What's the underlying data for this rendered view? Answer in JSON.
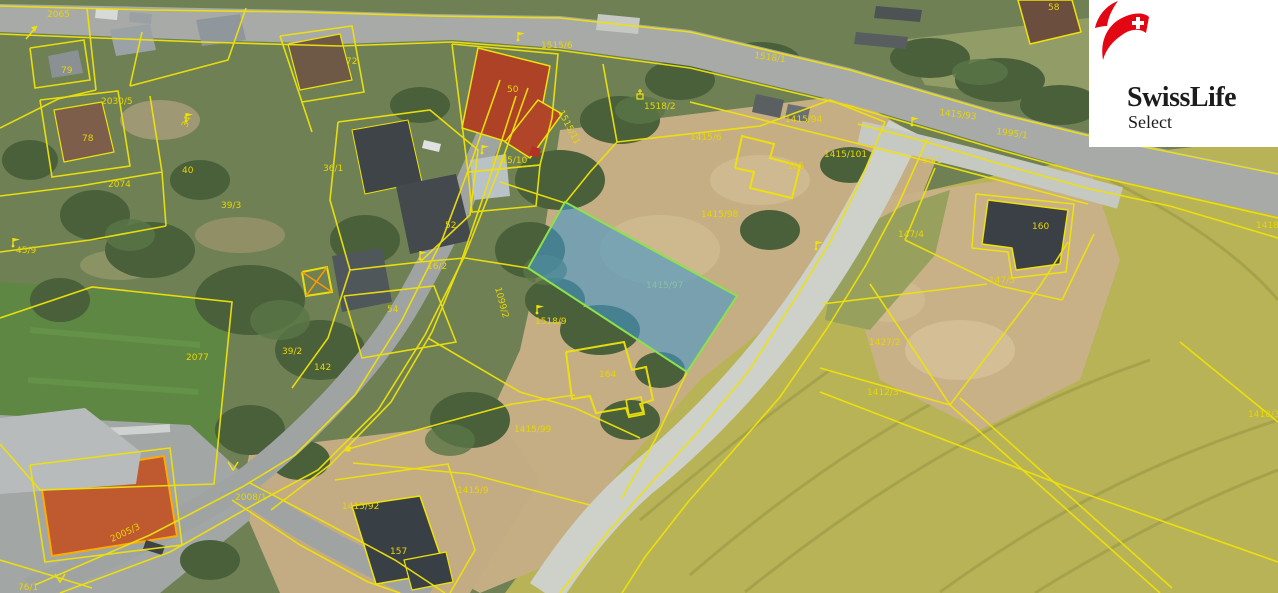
{
  "map": {
    "description": "aerial cadastral map",
    "colors": {
      "cadastral_line": "#efe20a",
      "label": "#e8d600",
      "highlight_fill": "#4596cb",
      "highlight_fill_opacity": 0.6,
      "highlight_stroke": "#8ce24a",
      "orange_highlight": "#ffa200",
      "field": "#b8b356",
      "dirt": "#c6ae84",
      "road": "#a8aaa7",
      "gravel": "#cdd1ca"
    },
    "highlight_parcel": {
      "label": "1415/97"
    },
    "labels": [
      {
        "t": "2065",
        "x": 47,
        "y": 17
      },
      {
        "t": "79",
        "x": 61,
        "y": 73
      },
      {
        "t": "2030/5",
        "x": 101,
        "y": 104
      },
      {
        "t": "78",
        "x": 82,
        "y": 141
      },
      {
        "t": "34",
        "x": 187,
        "y": 128,
        "r": -70
      },
      {
        "t": "40",
        "x": 182,
        "y": 173
      },
      {
        "t": "2074",
        "x": 108,
        "y": 187
      },
      {
        "t": "45/9",
        "x": 16,
        "y": 253
      },
      {
        "t": "39/3",
        "x": 221,
        "y": 208
      },
      {
        "t": "36/1",
        "x": 323,
        "y": 171
      },
      {
        "t": "72",
        "x": 346,
        "y": 64
      },
      {
        "t": "52",
        "x": 445,
        "y": 228
      },
      {
        "t": "16/2",
        "x": 427,
        "y": 269
      },
      {
        "t": "54",
        "x": 387,
        "y": 312
      },
      {
        "t": "2077",
        "x": 186,
        "y": 360
      },
      {
        "t": "39/2",
        "x": 282,
        "y": 354
      },
      {
        "t": "142",
        "x": 314,
        "y": 370
      },
      {
        "t": "1515/6",
        "x": 541,
        "y": 48
      },
      {
        "t": "50",
        "x": 507,
        "y": 92
      },
      {
        "t": "1515/10",
        "x": 490,
        "y": 163
      },
      {
        "t": "1515/11",
        "x": 558,
        "y": 112,
        "r": 62
      },
      {
        "t": "1518/2",
        "x": 644,
        "y": 109
      },
      {
        "t": "1415/6",
        "x": 690,
        "y": 140
      },
      {
        "t": "1415/94",
        "x": 785,
        "y": 122
      },
      {
        "t": "1518/1",
        "x": 754,
        "y": 58,
        "r": 8
      },
      {
        "t": "1415/93",
        "x": 939,
        "y": 115,
        "r": 7
      },
      {
        "t": "1995/1",
        "x": 996,
        "y": 134,
        "r": 8
      },
      {
        "t": "58",
        "x": 1048,
        "y": 10
      },
      {
        "t": "58/1",
        "x": 922,
        "y": 163
      },
      {
        "t": "1415/98",
        "x": 701,
        "y": 217
      },
      {
        "t": "165",
        "x": 787,
        "y": 169
      },
      {
        "t": "1415/101",
        "x": 824,
        "y": 157
      },
      {
        "t": "160",
        "x": 1032,
        "y": 229
      },
      {
        "t": "147/4",
        "x": 898,
        "y": 237
      },
      {
        "t": "147/5",
        "x": 989,
        "y": 283
      },
      {
        "t": "1427/2",
        "x": 869,
        "y": 345
      },
      {
        "t": "1412/3",
        "x": 867,
        "y": 395
      },
      {
        "t": "1418/3",
        "x": 1248,
        "y": 417
      },
      {
        "t": "1418/5",
        "x": 1256,
        "y": 228
      },
      {
        "t": "1099/2",
        "x": 495,
        "y": 288,
        "r": 75
      },
      {
        "t": "1518/9",
        "x": 535,
        "y": 324
      },
      {
        "t": "164",
        "x": 599,
        "y": 377
      },
      {
        "t": "1415/97",
        "x": 646,
        "y": 288,
        "c": "#9fd6a0",
        "o": 0.5
      },
      {
        "t": "1415/99",
        "x": 514,
        "y": 432
      },
      {
        "t": "1415/9",
        "x": 457,
        "y": 493
      },
      {
        "t": "1415/92",
        "x": 342,
        "y": 509
      },
      {
        "t": "157",
        "x": 390,
        "y": 554
      },
      {
        "t": "2008/1",
        "x": 235,
        "y": 500
      },
      {
        "t": "2005/3",
        "x": 112,
        "y": 542,
        "r": -25
      },
      {
        "t": "76/1",
        "x": 18,
        "y": 590
      }
    ],
    "symbols": [
      {
        "type": "flag",
        "x": 13,
        "y": 243
      },
      {
        "type": "flag",
        "x": 186,
        "y": 118
      },
      {
        "type": "flag",
        "x": 420,
        "y": 256
      },
      {
        "type": "flag",
        "x": 537,
        "y": 310
      },
      {
        "type": "flag",
        "x": 482,
        "y": 150
      },
      {
        "type": "flag",
        "x": 518,
        "y": 37
      },
      {
        "type": "flag",
        "x": 912,
        "y": 122
      },
      {
        "type": "flag",
        "x": 816,
        "y": 246
      },
      {
        "type": "shrine",
        "x": 640,
        "y": 96
      },
      {
        "type": "square",
        "x": 348,
        "y": 449
      },
      {
        "type": "vmark",
        "x": 60,
        "y": 578
      },
      {
        "type": "vmark",
        "x": 233,
        "y": 466
      },
      {
        "type": "arrow",
        "x": 32,
        "y": 32
      }
    ]
  },
  "logo": {
    "icon": "swiss-flag-icon",
    "brand": "SwissLife",
    "product": "Select",
    "accent": "#e30613",
    "cross_color": "#ffffff"
  }
}
